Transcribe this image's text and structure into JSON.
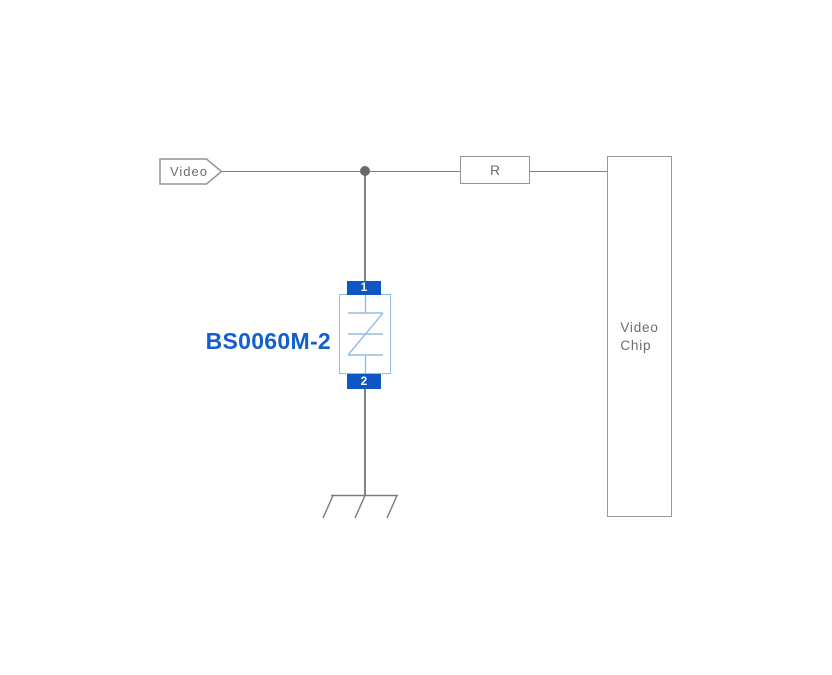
{
  "schematic": {
    "net_label": {
      "text": "Video"
    },
    "resistor": {
      "label": "R"
    },
    "video_chip": {
      "label": "Video\nChip"
    },
    "protection_device": {
      "part_number": "BS0060M-2",
      "pin_top": "1",
      "pin_bottom": "2"
    },
    "colors": {
      "background": "#ffffff",
      "wire_gray": "#828282",
      "outline_gray": "#949494",
      "text_gray": "#6d6d6d",
      "junction_gray": "#6a6a6a",
      "pad_blue": "#0d57c4",
      "device_outline_blue": "#94bbe1",
      "part_label_blue": "#1360cd"
    }
  }
}
